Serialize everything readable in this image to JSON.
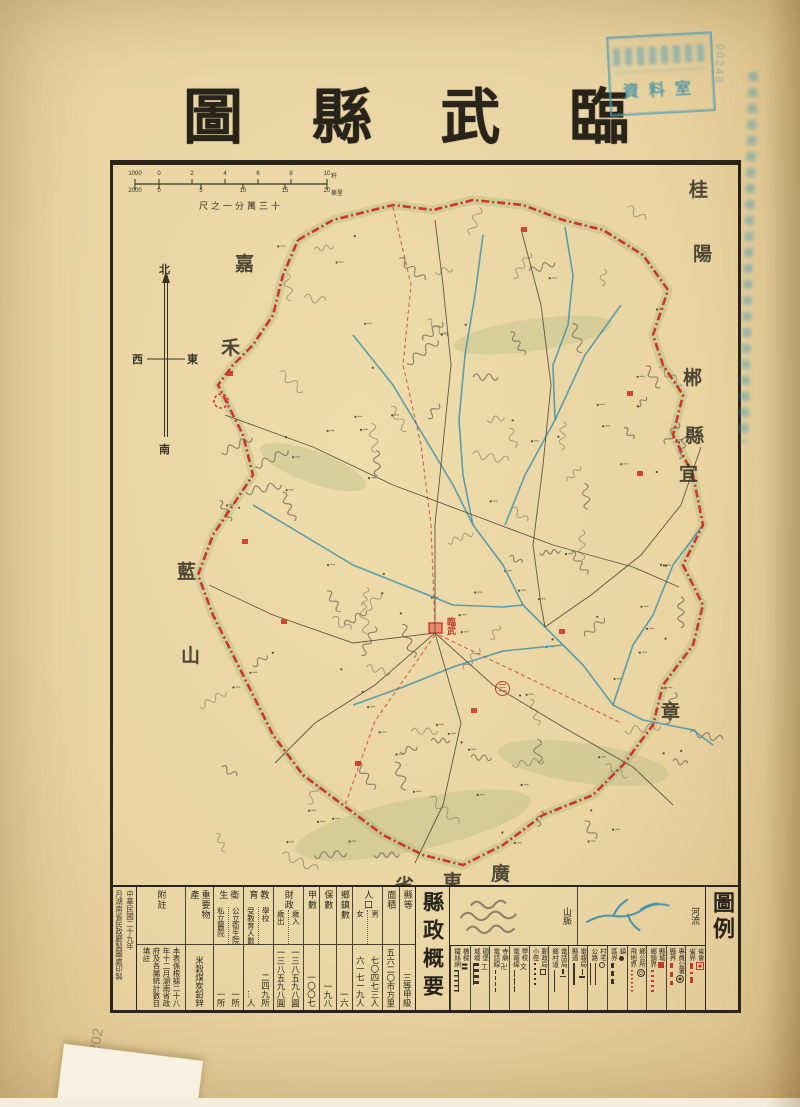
{
  "title": {
    "text": "臨武縣圖"
  },
  "scale": {
    "caption": "十三萬分一之尺",
    "top_ticks": [
      "1000",
      "0",
      "2",
      "4",
      "6",
      "8",
      "10"
    ],
    "top_unit": "粁",
    "bottom_ticks": [
      "2000",
      "0",
      "5",
      "10",
      "15",
      "20"
    ],
    "bottom_unit": "華里"
  },
  "compass": {
    "north": "北",
    "south": "南",
    "east": "東",
    "west": "西"
  },
  "map": {
    "county_seat_label": "臨武",
    "district_numeral": "三",
    "border_labels": [
      {
        "ch": "桂",
        "x": 576,
        "y": 10
      },
      {
        "ch": "陽",
        "x": 580,
        "y": 74
      },
      {
        "ch": "嘉",
        "x": 122,
        "y": 84
      },
      {
        "ch": "禾",
        "x": 108,
        "y": 168
      },
      {
        "ch": "郴",
        "x": 570,
        "y": 198
      },
      {
        "ch": "縣",
        "x": 572,
        "y": 256
      },
      {
        "ch": "宜",
        "x": 566,
        "y": 294
      },
      {
        "ch": "章",
        "x": 548,
        "y": 532
      },
      {
        "ch": "藍",
        "x": 64,
        "y": 392
      },
      {
        "ch": "山",
        "x": 68,
        "y": 476
      },
      {
        "ch": "廣",
        "x": 378,
        "y": 694
      },
      {
        "ch": "東",
        "x": 330,
        "y": 702
      },
      {
        "ch": "省",
        "x": 282,
        "y": 706
      }
    ]
  },
  "table": {
    "title": "縣政概要",
    "columns": [
      {
        "header": "縣等",
        "value": "三等甲級"
      },
      {
        "header": "面積",
        "value": "五六二〇市方里"
      },
      {
        "header": "人口",
        "subs": [
          {
            "header": "男",
            "value": "七〇四七三人"
          },
          {
            "header": "女",
            "value": "六一七一九人"
          }
        ]
      },
      {
        "header": "鄉鎮數",
        "value": "一六"
      },
      {
        "header": "保數",
        "value": "一九八"
      },
      {
        "header": "甲數",
        "value": "一〇〇七"
      },
      {
        "header": "財政",
        "subs": [
          {
            "header": "歲入",
            "value": "一三八五九八圓"
          },
          {
            "header": "歲出",
            "value": "一三八五九八圓"
          }
        ]
      },
      {
        "header": "教育",
        "subs": [
          {
            "header": "學校",
            "value": "二四九所"
          },
          {
            "header": "受教育人數",
            "value": "…人"
          }
        ]
      },
      {
        "header": "衛生",
        "subs": [
          {
            "header": "公立衛生院",
            "value": "一所"
          },
          {
            "header": "私立醫院",
            "value": "一所"
          }
        ]
      },
      {
        "header": "重要物產",
        "value": "米穀煤炭鉛鋅"
      },
      {
        "header": "附註",
        "value": "本表係根據二十八年十二月湖南省政府及各屬統計數目填註",
        "notes": true
      }
    ]
  },
  "legend": {
    "title": "圖例",
    "terrain": [
      {
        "label": "山脈"
      },
      {
        "label": "河流"
      }
    ],
    "items": [
      {
        "point": "省會",
        "sym": "seat-red",
        "line": "省界",
        "line_style": "red-dashdot"
      },
      {
        "point": "專員公署",
        "sym": "bullseye",
        "line": "縣界",
        "line_style": "red-dash"
      },
      {
        "point": "縣城",
        "sym": "red-square",
        "line": "鄉鎮界",
        "line_style": "red-dot"
      },
      {
        "point": "鄉公所",
        "sym": "double-circle",
        "line": "飛地界",
        "line_style": "red-finedot"
      },
      {
        "point": "鎮",
        "sym": "dot",
        "line": "區界",
        "line_style": "black-dash"
      },
      {
        "point": "村宅",
        "sym": "circle",
        "line": "公路",
        "line_style": "black-double"
      },
      {
        "point": "電報局",
        "sym": "pole",
        "line": "縣道",
        "line_style": "black-solid"
      },
      {
        "point": "電話局",
        "sym": "pole2",
        "line": "鄉村道",
        "line_style": "black-thin"
      },
      {
        "point": "郵政局",
        "sym": "square-open",
        "line": "小徑",
        "line_style": "black-dotted"
      },
      {
        "point": "學校",
        "glyph": "文",
        "line": "電報線",
        "line_style": "wire"
      },
      {
        "point": "寺廟",
        "glyph": "卍",
        "line": "電話線",
        "line_style": "wire2"
      },
      {
        "point": "碉堡",
        "glyph": "工",
        "line": "城墻",
        "line_style": "wall"
      },
      {
        "point": "橋樑",
        "glyph": "〓",
        "line": "鐵絲網",
        "line_style": "wirefence"
      }
    ]
  },
  "colophon": {
    "line1": "中華民國二十九年",
    "line2": "月湖南省民政廳製圖處印製"
  },
  "stamps": {
    "reading_room": "資料室",
    "catalog": "00248",
    "pencil": "202"
  }
}
